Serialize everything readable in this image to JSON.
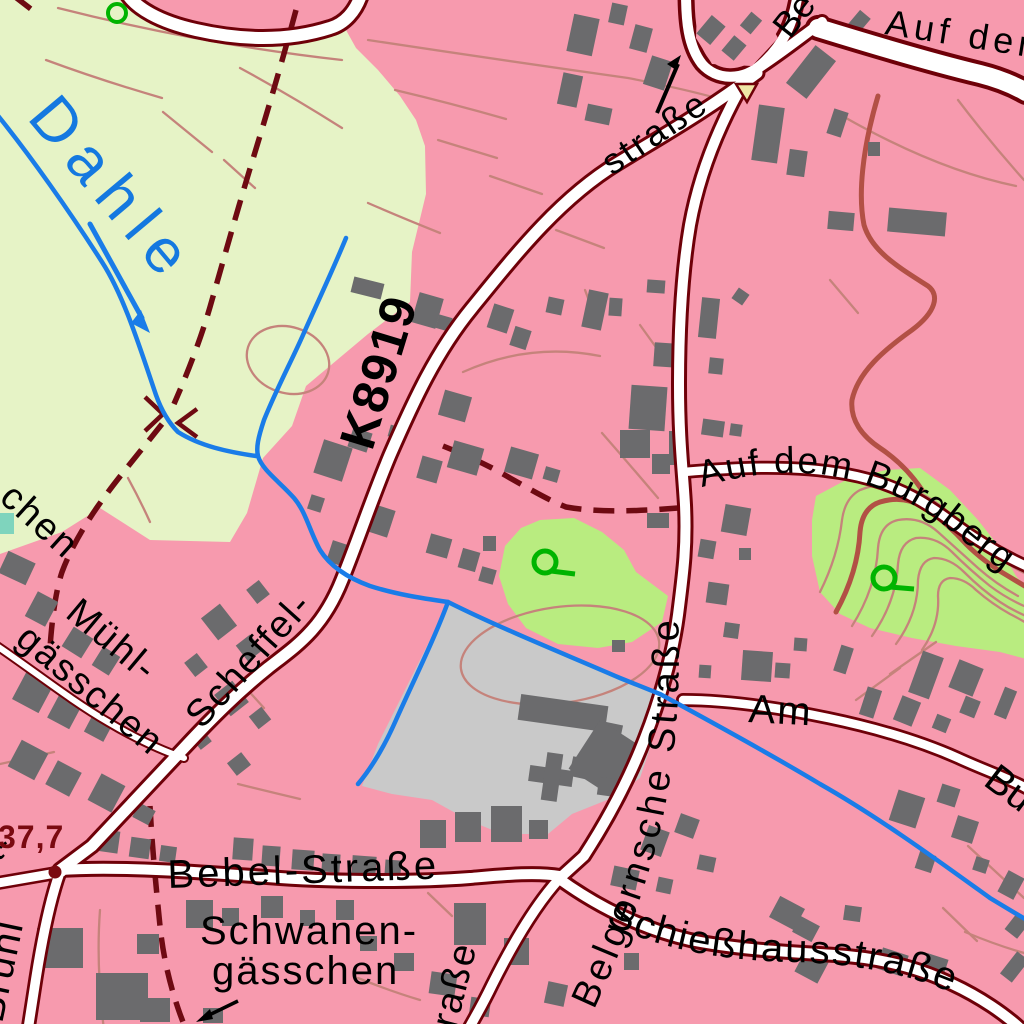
{
  "map": {
    "title": "Topographic city map extract",
    "labels": {
      "river": "Dahle",
      "road_ref": "K8919",
      "strasse_partial_top": "straße",
      "be_partial_top": "Be",
      "auf_dem_partial_top": "Auf dem",
      "auf_dem_burgberg": "Auf dem Burgberg",
      "belgernsche_strasse": "Belgernsche Straße",
      "am_partial": "Am",
      "bu_partial": "Bu",
      "muehl_line1": "Mühl-",
      "muehl_line2": "gässchen",
      "gaesschen_partial": "chen",
      "scheffel": "Scheffel-",
      "bebel_strasse": "Bebel-Straße",
      "schwanen_line1": "Schwanen-",
      "schwanen_line2": "gässchen",
      "schiesshausstrasse": "Schießhausstraße",
      "strasse_partial_bottom": "straße",
      "bruehl": "Brühl",
      "t_partial": "t-",
      "spot_elevation": "37,7"
    },
    "symbols": {
      "spring_icon": "green circle with outlet tick (Quelle)",
      "tree_icon": "small green ring",
      "flow_arrow_icon": "blue stream flow arrow",
      "one_way_arrow_icon": "black one-way arrow",
      "leader_arrow_icon": "black label leader arrow",
      "traffic_island_icon": "yellow triangle island",
      "junction_dot_icon": "dark red spot-height dot"
    },
    "colors": {
      "urban_pink": "#f79aae",
      "field_green": "#e6f3c6",
      "park_green": "#b9ec80",
      "building_gray": "#6b6b6d",
      "parcel_gray": "#c9c9c9",
      "road_fill": "#ffffff",
      "road_casing": "#6e0008",
      "contour": "#c5837b",
      "index_contour": "#b25045",
      "water": "#1a7ce8",
      "boundary": "#6e0a12",
      "label_black": "#000000",
      "water_label": "#1478e0",
      "spot_height": "#7a0a10",
      "spring_green": "#00b400",
      "island_yellow": "#efe6a6",
      "pool_teal": "#7fd4bd"
    }
  }
}
